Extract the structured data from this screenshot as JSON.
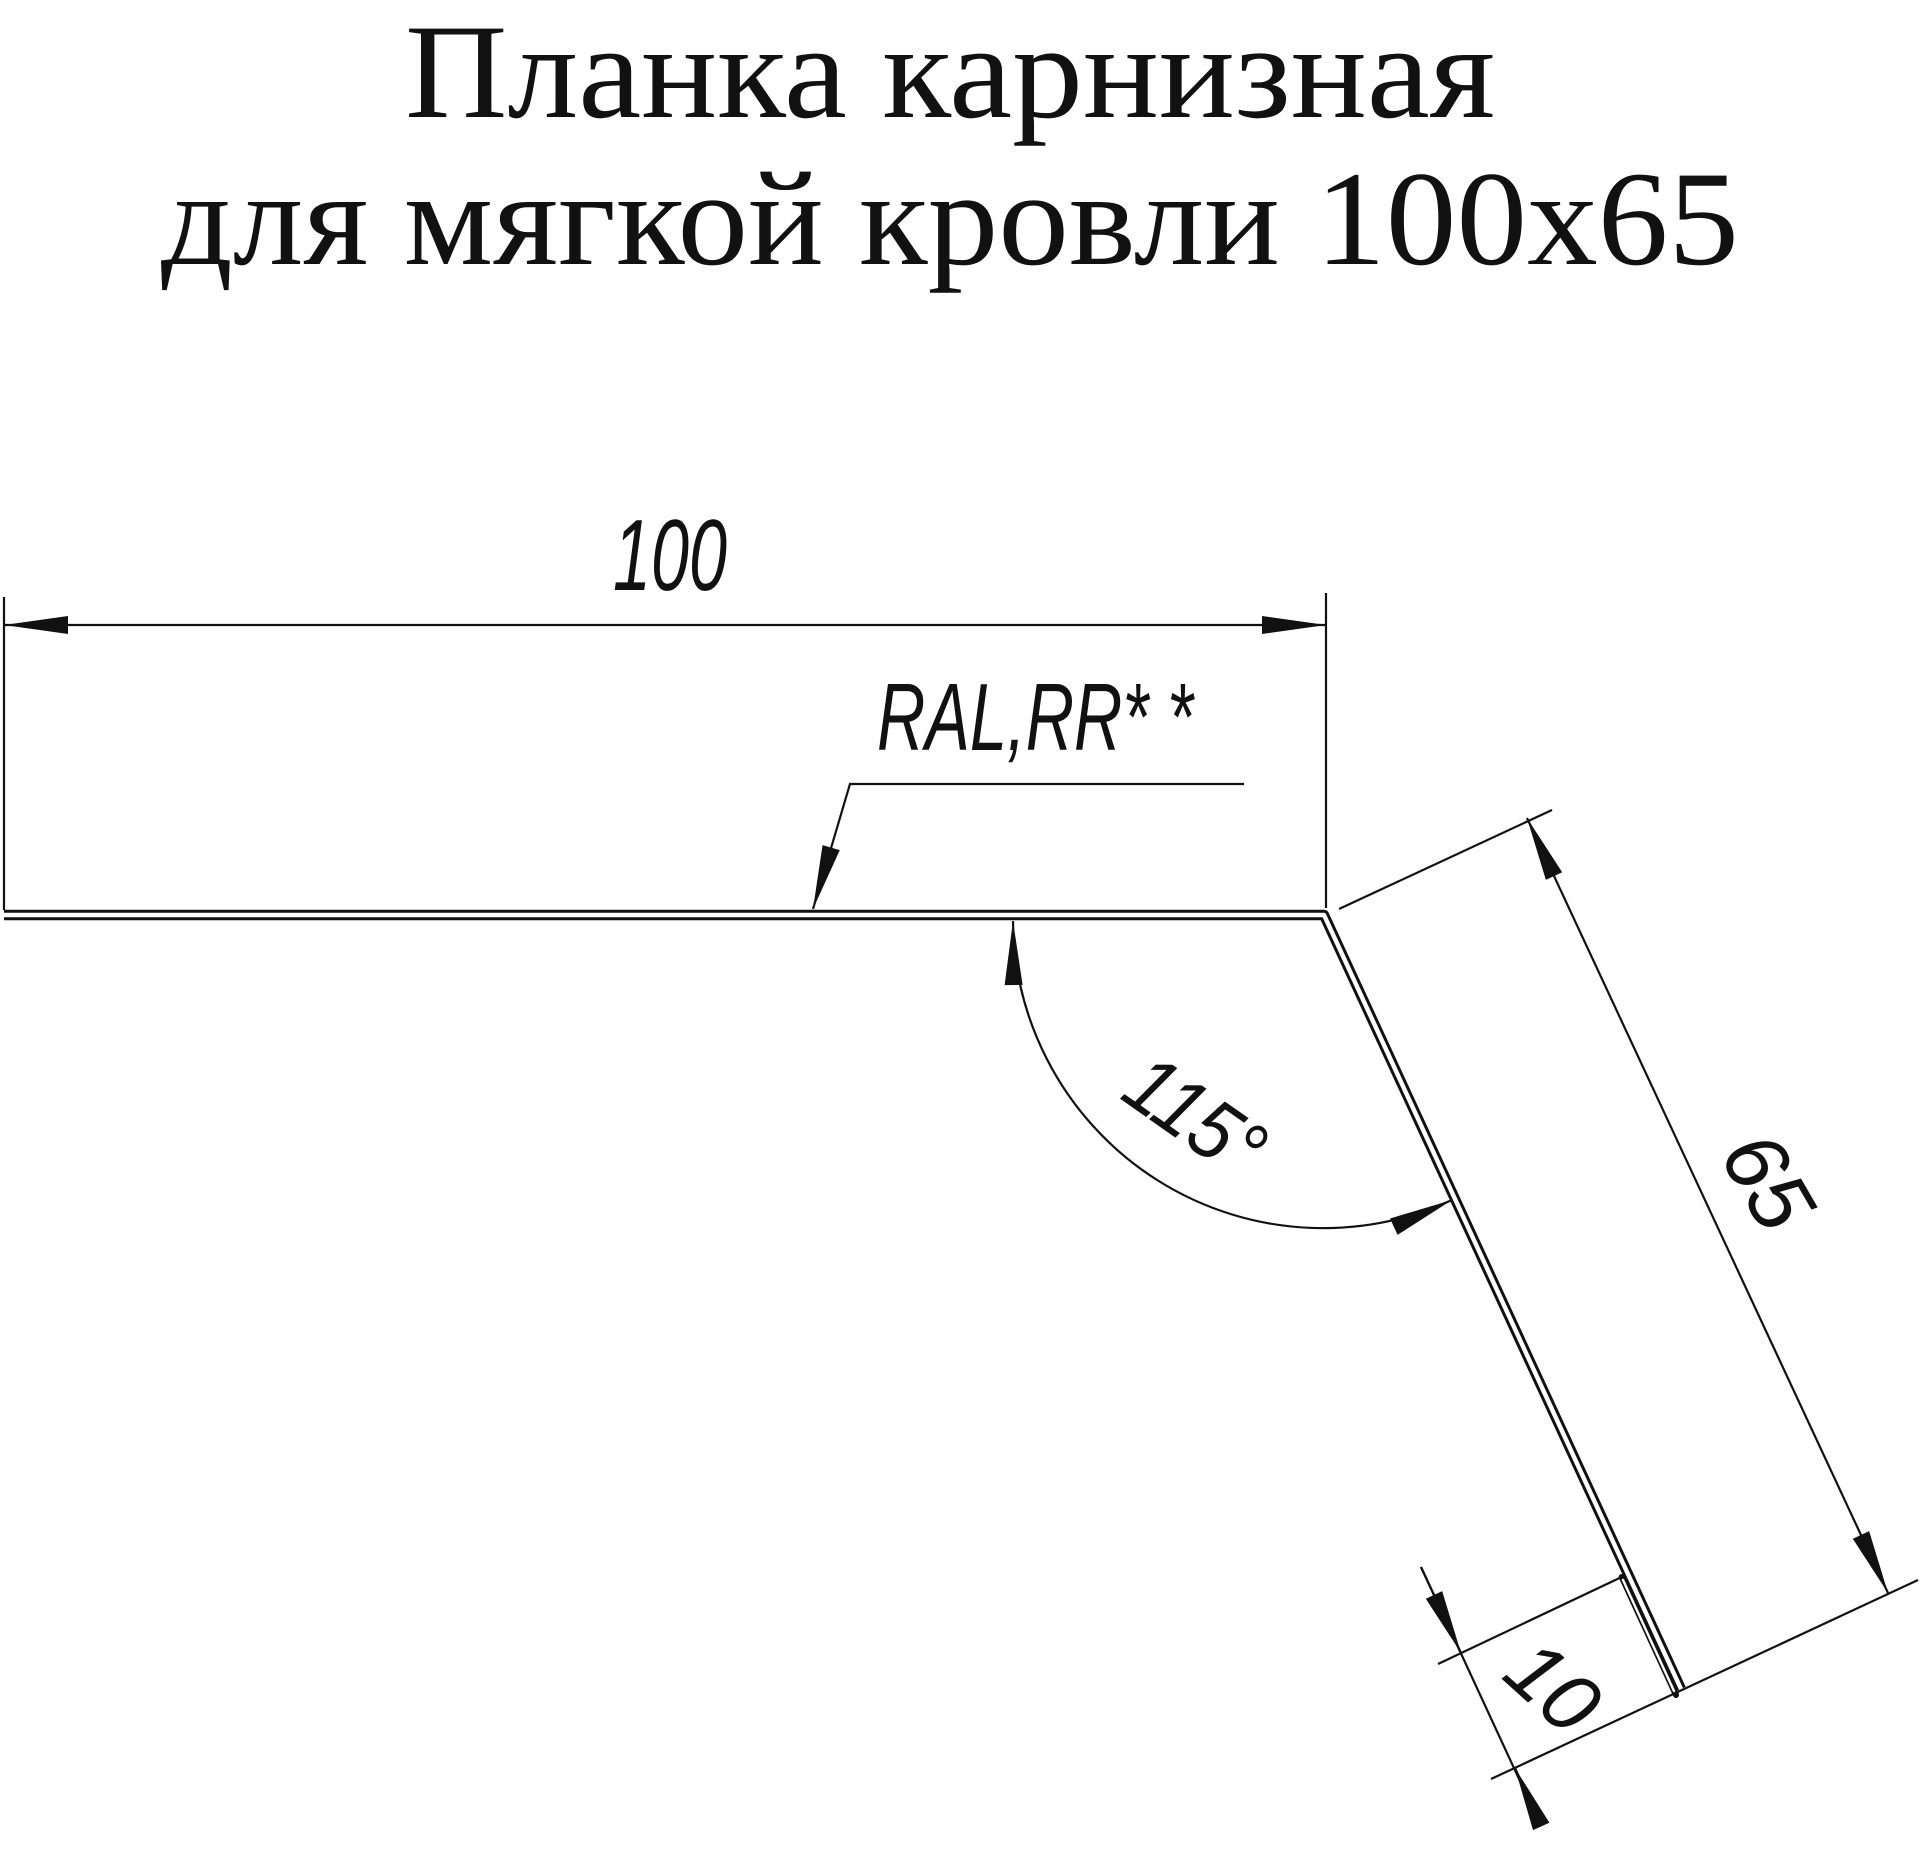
{
  "colors": {
    "background": "#ffffff",
    "ink": "#111111"
  },
  "title": {
    "line1": "Планка карнизная",
    "line2": "для мягкой кровли 100x65"
  },
  "drawing": {
    "dim_width": "100",
    "dim_flap": "65",
    "dim_angle": "115°",
    "dim_hem": "10",
    "coating_note": "RAL,RR* *"
  }
}
